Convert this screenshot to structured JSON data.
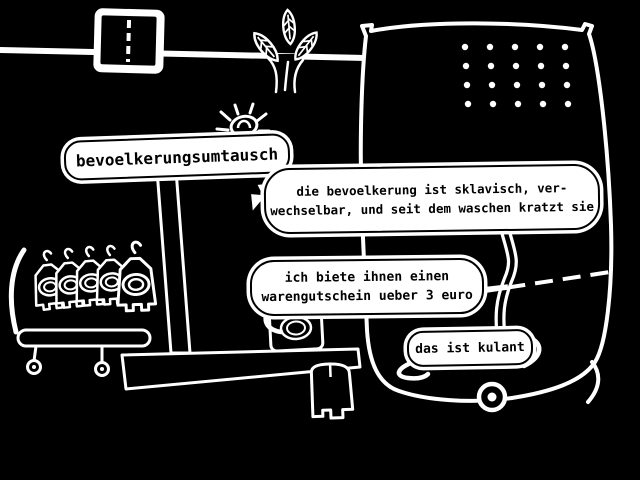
{
  "scene": {
    "title": "bevoelkerungsumtausch scene",
    "colors": {
      "background": "#000000",
      "ink": "#ffffff"
    },
    "sign_label": {
      "text": "bevoelkerungsumtausch"
    },
    "dialogue": {
      "bubble1": {
        "line1": "die bevoelkerung ist sklavisch, ver-",
        "line2": "wechselbar, und seit dem waschen kratzt sie"
      },
      "bubble2": {
        "line1": "ich biete ihnen einen",
        "line2": "warengutschein ueber 3 euro"
      },
      "bubble3": {
        "line1": "das ist kulant"
      }
    },
    "icons": {
      "road-sign-icon": "white rounded square, black face, dashed center line",
      "plant-icon": "three outlined leaves with veins on a trunk",
      "bug-icon": "black beetle with white legs on sign",
      "garment-icon": "hooded jacket on hanger hook with oval label, five on rack",
      "trolley-icon": "black bar with two small wheels",
      "vending-machine-icon": "large black rounded machine, 5x4 speaker holes, dashed seam, wheel",
      "wheel-icon": "white ring with center dot",
      "voucher-box-icon": "black box with concentric white oval",
      "creature-icon": "small black rounded figure with two feet",
      "bench-icon": "long black slab table"
    },
    "machine": {
      "speaker_hole_rows": 4,
      "speaker_hole_cols": 5
    }
  }
}
